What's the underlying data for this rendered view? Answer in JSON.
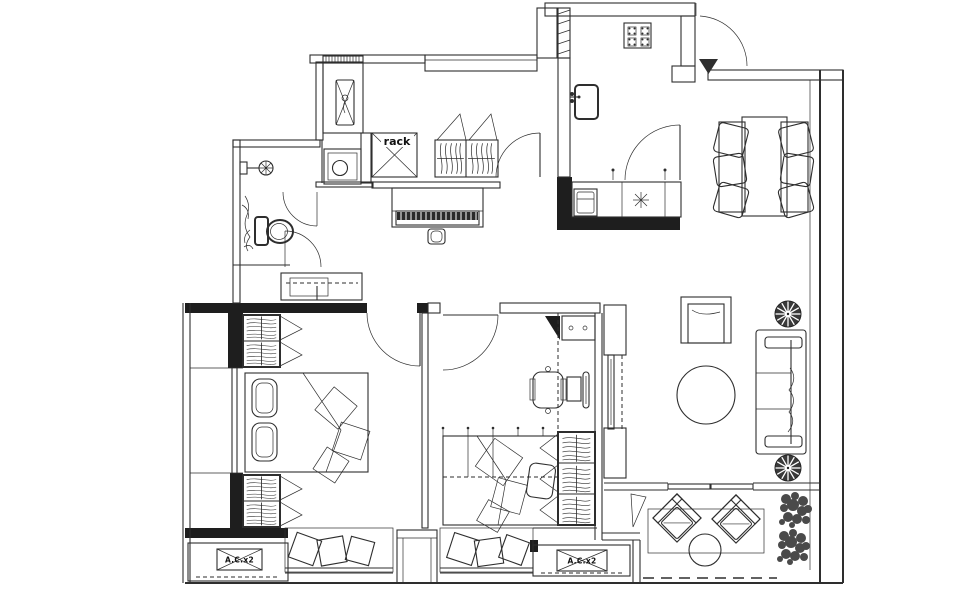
{
  "floor_plan": {
    "labels": {
      "rack": "rack",
      "ac_unit_left": "A.C.x2",
      "ac_unit_right": "A.C.x2"
    },
    "colors": {
      "line": "#2e2e2e",
      "wall_fill": "#1e1e1e",
      "background": "#ffffff",
      "foliage": "#4a4a4a"
    },
    "icon_names": [
      "washing-machine",
      "storage-rack",
      "coat-closet",
      "bathroom-sink",
      "shower",
      "toilet",
      "bathroom-plant",
      "kitchen-stove",
      "kitchen-sink",
      "kitchen-counter",
      "entry-arrow",
      "dining-table",
      "dining-chair",
      "piano",
      "piano-stool",
      "hall-cabinet",
      "double-bed",
      "pillow",
      "wardrobe-hanging-clothes",
      "bay-window-cushion",
      "ac-unit",
      "desk",
      "desk-chair",
      "single-bed",
      "tv-cabinet",
      "tv",
      "armchair",
      "round-coffee-table",
      "sofa",
      "potted-plant",
      "lounge-chair",
      "balcony-table",
      "shrub",
      "balcony-rug"
    ]
  }
}
